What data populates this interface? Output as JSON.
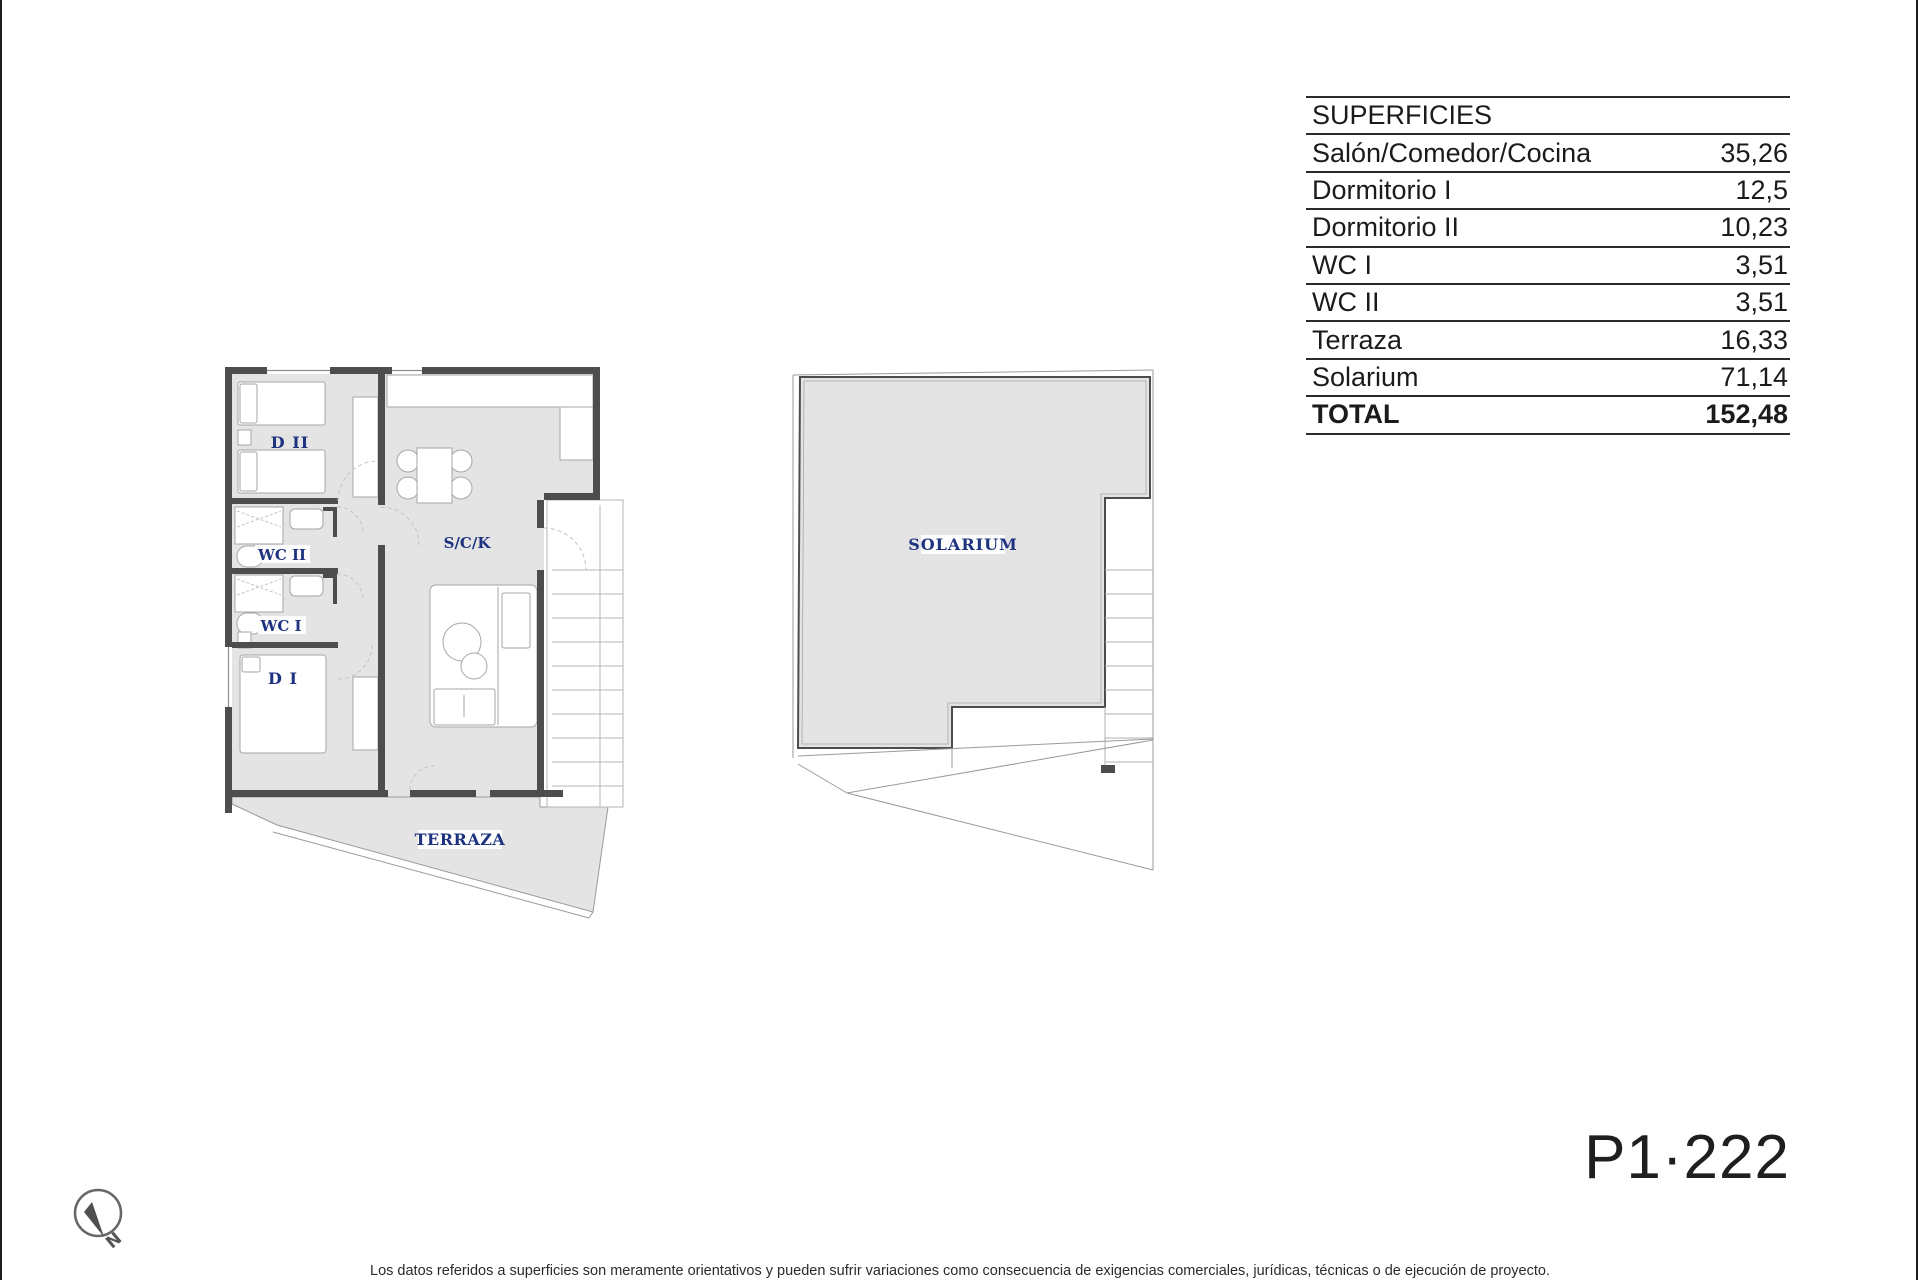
{
  "surfaces_table": {
    "title": "SUPERFICIES",
    "rows": [
      {
        "label": "Salón/Comedor/Cocina",
        "value": "35,26"
      },
      {
        "label": "Dormitorio I",
        "value": "12,5"
      },
      {
        "label": "Dormitorio II",
        "value": "10,23"
      },
      {
        "label": "WC I",
        "value": "3,51"
      },
      {
        "label": "WC II",
        "value": "3,51"
      },
      {
        "label": "Terraza",
        "value": "16,33"
      },
      {
        "label": "Solarium",
        "value": "71,14"
      }
    ],
    "total": {
      "label": "TOTAL",
      "value": "152,48"
    }
  },
  "plans": {
    "apartment": {
      "rooms": {
        "d2": {
          "label": "D II"
        },
        "wc2": {
          "label": "WC II"
        },
        "wc1": {
          "label": "WC I"
        },
        "d1": {
          "label": "D I"
        },
        "sck": {
          "label": "S/C/K"
        },
        "terraza": {
          "label": "TERRAZA"
        }
      }
    },
    "solarium": {
      "label": "SOLARIUM"
    }
  },
  "page": {
    "plan_code": "P1·222",
    "north_label": "N",
    "disclaimer": "Los datos referidos a superficies son meramente orientativos y pueden sufrir variaciones como consecuencia de exigencias comerciales, jurídicas, técnicas o de ejecución de proyecto."
  },
  "colors": {
    "label_navy": "#1e3380",
    "floor_gray": "#e4e4e4",
    "wall_dark": "#4d4d4d"
  }
}
